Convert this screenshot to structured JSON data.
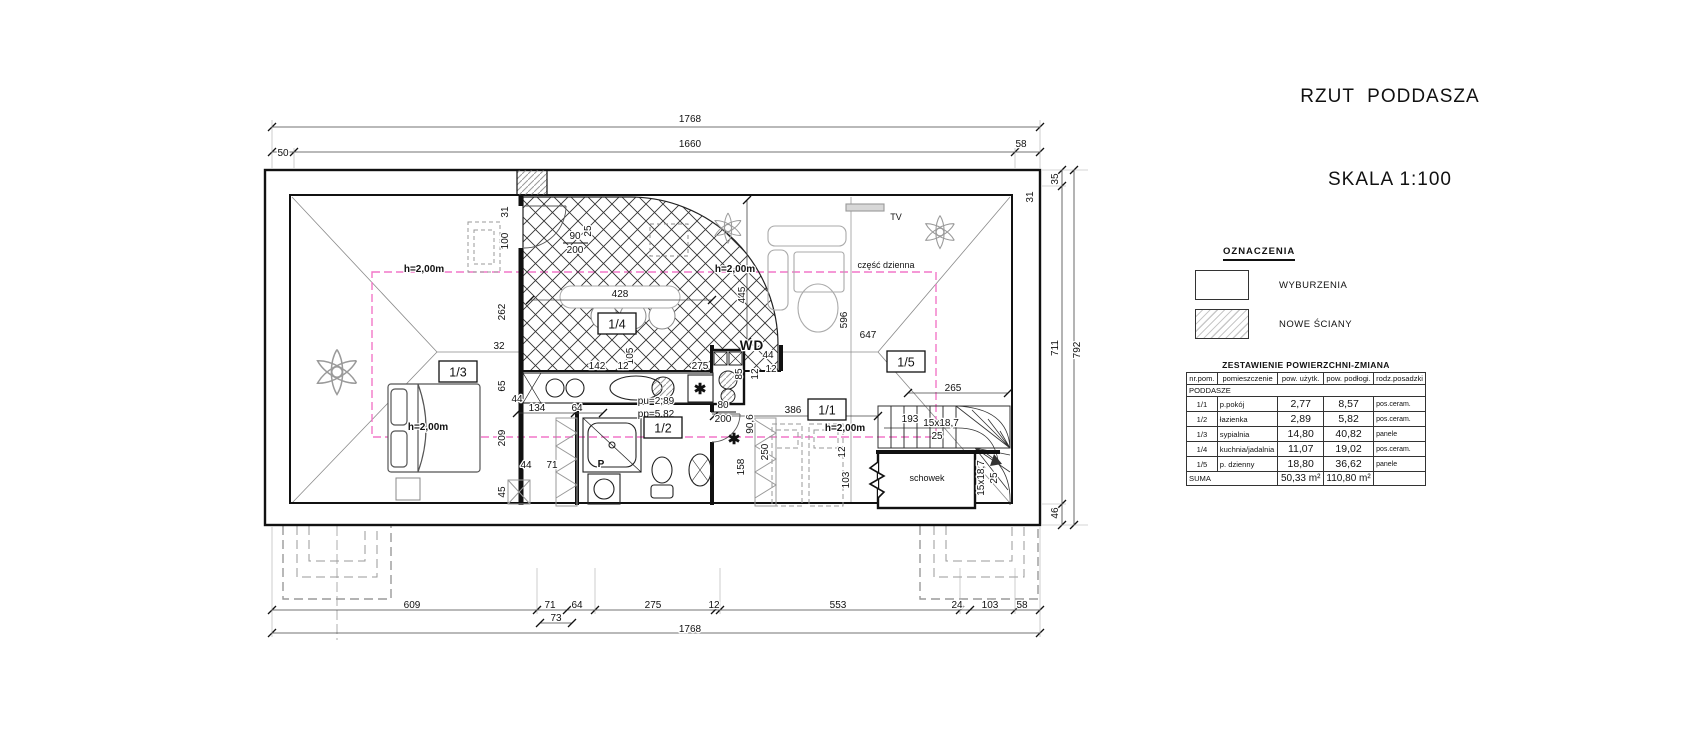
{
  "title": {
    "line1": "RZUT  PODDASZA",
    "line2": "SKALA 1:100"
  },
  "legend": {
    "heading": "OZNACZENIA",
    "items": [
      {
        "label": "WYBURZENIA",
        "style": "plain"
      },
      {
        "label": "NOWE ŚCIANY",
        "style": "hatched"
      }
    ]
  },
  "area_table": {
    "title": "ZESTAWIENIE POWIERZCHNI-ZMIANA",
    "columns": [
      "nr.pom.",
      "pomieszczenie",
      "pow. użytk.",
      "pow. podłogi.",
      "rodz.posadzki"
    ],
    "section": "PODDASZE",
    "rows": [
      [
        "1/1",
        "p.pokój",
        "2,77",
        "8,57",
        "pos.ceram."
      ],
      [
        "1/2",
        "łazienka",
        "2,89",
        "5,82",
        "pos.ceram."
      ],
      [
        "1/3",
        "sypialnia",
        "14,80",
        "40,82",
        "panele"
      ],
      [
        "1/4",
        "kuchnia/jadalnia",
        "11,07",
        "19,02",
        "pos.ceram."
      ],
      [
        "1/5",
        "p. dzienny",
        "18,80",
        "36,62",
        "panele"
      ]
    ],
    "summary": {
      "label": "SUMA",
      "pow_uzytk": "50,33 m²",
      "pow_podlogi": "110,80 m²"
    }
  },
  "plan": {
    "accent_magenta": "#f277c8",
    "room_tags": [
      {
        "x": 458,
        "y": 372,
        "t": "1/3"
      },
      {
        "x": 617,
        "y": 324,
        "t": "1/4"
      },
      {
        "x": 663,
        "y": 428,
        "t": "1/2"
      },
      {
        "x": 827,
        "y": 410,
        "t": "1/1"
      },
      {
        "x": 906,
        "y": 362,
        "t": "1/5"
      }
    ],
    "labels": [
      {
        "x": 690,
        "y": 122,
        "t": "1768"
      },
      {
        "x": 690,
        "y": 147,
        "t": "1660"
      },
      {
        "x": 283,
        "y": 156,
        "t": "50"
      },
      {
        "x": 1021,
        "y": 147,
        "t": "58"
      },
      {
        "x": 412,
        "y": 608,
        "t": "609"
      },
      {
        "x": 550,
        "y": 608,
        "t": "71"
      },
      {
        "x": 577,
        "y": 608,
        "t": "64"
      },
      {
        "x": 653,
        "y": 608,
        "t": "275"
      },
      {
        "x": 714,
        "y": 608,
        "t": "12"
      },
      {
        "x": 838,
        "y": 608,
        "t": "553"
      },
      {
        "x": 957,
        "y": 608,
        "t": "24"
      },
      {
        "x": 990,
        "y": 608,
        "t": "103"
      },
      {
        "x": 1022,
        "y": 608,
        "t": "58"
      },
      {
        "x": 556,
        "y": 621,
        "t": "73"
      },
      {
        "x": 690,
        "y": 632,
        "t": "1768"
      },
      {
        "x": 1058,
        "y": 179,
        "t": "35",
        "r": 1
      },
      {
        "x": 1058,
        "y": 348,
        "t": "711",
        "r": 1
      },
      {
        "x": 1080,
        "y": 350,
        "t": "792",
        "r": 1
      },
      {
        "x": 1058,
        "y": 513,
        "t": "46",
        "r": 1
      },
      {
        "x": 1033,
        "y": 197,
        "t": "31",
        "r": 1
      },
      {
        "x": 508,
        "y": 212,
        "t": "31",
        "r": 1
      },
      {
        "x": 508,
        "y": 241,
        "t": "100",
        "r": 1
      },
      {
        "x": 505,
        "y": 312,
        "t": "262",
        "r": 1
      },
      {
        "x": 499,
        "y": 349,
        "t": "32"
      },
      {
        "x": 505,
        "y": 386,
        "t": "65",
        "r": 1
      },
      {
        "x": 517,
        "y": 402,
        "t": "44"
      },
      {
        "x": 505,
        "y": 438,
        "t": "209",
        "r": 1
      },
      {
        "x": 505,
        "y": 492,
        "t": "45",
        "r": 1
      },
      {
        "x": 526,
        "y": 468,
        "t": "44"
      },
      {
        "x": 552,
        "y": 468,
        "t": "71"
      },
      {
        "x": 537,
        "y": 411,
        "t": "134"
      },
      {
        "x": 577,
        "y": 411,
        "t": "64"
      },
      {
        "x": 575,
        "y": 239,
        "t": "90"
      },
      {
        "x": 575,
        "y": 253,
        "t": "200"
      },
      {
        "x": 591,
        "y": 231,
        "t": "25",
        "r": 1
      },
      {
        "x": 620,
        "y": 297,
        "t": "428"
      },
      {
        "x": 633,
        "y": 356,
        "t": "105",
        "r": 1
      },
      {
        "x": 597,
        "y": 369,
        "t": "142"
      },
      {
        "x": 623,
        "y": 369,
        "t": "12"
      },
      {
        "x": 700,
        "y": 369,
        "t": "275"
      },
      {
        "x": 768,
        "y": 358,
        "t": "44"
      },
      {
        "x": 771,
        "y": 372,
        "t": "12"
      },
      {
        "x": 745,
        "y": 295,
        "t": "445",
        "r": 1
      },
      {
        "x": 742,
        "y": 374,
        "t": "85",
        "r": 1
      },
      {
        "x": 758,
        "y": 374,
        "t": "12",
        "r": 1
      },
      {
        "x": 723,
        "y": 408,
        "t": "80"
      },
      {
        "x": 723,
        "y": 422,
        "t": "200"
      },
      {
        "x": 753,
        "y": 424,
        "t": "90,6",
        "r": 1
      },
      {
        "x": 744,
        "y": 467,
        "t": "158",
        "r": 1
      },
      {
        "x": 768,
        "y": 452,
        "t": "250",
        "r": 1
      },
      {
        "x": 793,
        "y": 413,
        "t": "386"
      },
      {
        "x": 845,
        "y": 452,
        "t": "12",
        "r": 1
      },
      {
        "x": 849,
        "y": 480,
        "t": "103",
        "r": 1
      },
      {
        "x": 847,
        "y": 320,
        "t": "596",
        "r": 1
      },
      {
        "x": 868,
        "y": 338,
        "t": "647"
      },
      {
        "x": 953,
        "y": 391,
        "t": "265"
      },
      {
        "x": 910,
        "y": 422,
        "t": "193"
      },
      {
        "x": 941,
        "y": 426,
        "t": "15x18,7"
      },
      {
        "x": 937,
        "y": 439,
        "t": "25"
      },
      {
        "x": 984,
        "y": 478,
        "t": "15x18,7",
        "r": 1
      },
      {
        "x": 997,
        "y": 478,
        "t": "25",
        "r": 1
      },
      {
        "x": 424,
        "y": 272,
        "t": "h=2,00m",
        "c": "h"
      },
      {
        "x": 735,
        "y": 272,
        "t": "h=2,00m",
        "c": "h"
      },
      {
        "x": 428,
        "y": 430,
        "t": "h=2,00m",
        "c": "h"
      },
      {
        "x": 845,
        "y": 431,
        "t": "h=2,00m",
        "c": "h"
      },
      {
        "x": 886,
        "y": 268,
        "t": "część dzienna",
        "c": "sm"
      },
      {
        "x": 896,
        "y": 220,
        "t": "TV",
        "c": "sm"
      },
      {
        "x": 752,
        "y": 350,
        "t": "WD",
        "c": "big"
      },
      {
        "x": 601,
        "y": 467,
        "t": "P",
        "c": "h"
      },
      {
        "x": 656,
        "y": 404,
        "t": "pu=2,89"
      },
      {
        "x": 656,
        "y": 417,
        "t": "pp=5,82"
      },
      {
        "x": 700,
        "y": 394,
        "t": "✱",
        "c": "star"
      },
      {
        "x": 734,
        "y": 444,
        "t": "✱",
        "c": "star"
      },
      {
        "x": 927,
        "y": 481,
        "t": "schowek",
        "c": "sm"
      }
    ]
  }
}
